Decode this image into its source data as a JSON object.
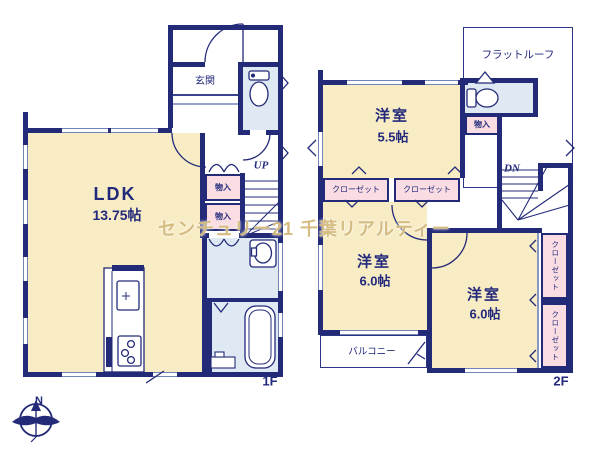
{
  "watermark": "センチュリー21 千葉リアルティー",
  "compass": {
    "north_label": "N"
  },
  "floor1": {
    "floor_label": "1F",
    "genkan": "玄関",
    "ldk_name": "LDK",
    "ldk_size": "13.75帖",
    "storage_upper": "物入",
    "storage_lower": "物入",
    "stairs_up": "UP"
  },
  "floor2": {
    "floor_label": "2F",
    "flat_roof": "フラットルーフ",
    "bedroom_a_name": "洋室",
    "bedroom_a_size": "5.5帖",
    "storage": "物入",
    "closet_a": "クローゼット",
    "closet_b": "クローゼット",
    "stairs_down": "DN",
    "bedroom_b_name": "洋室",
    "bedroom_b_size": "6.0帖",
    "bedroom_c_name": "洋室",
    "bedroom_c_size": "6.0帖",
    "closet_c": "クローゼット",
    "closet_d": "クローゼット",
    "balcony": "バルコニー"
  },
  "colors": {
    "wall_navy": "#232a78",
    "room_cream": "#f8ecc5",
    "closet_pink": "#f9dde2",
    "wet_area_blue": "#dfe9f4",
    "text_navy": "#232a7c",
    "watermark_gold": "#ceb06c"
  }
}
